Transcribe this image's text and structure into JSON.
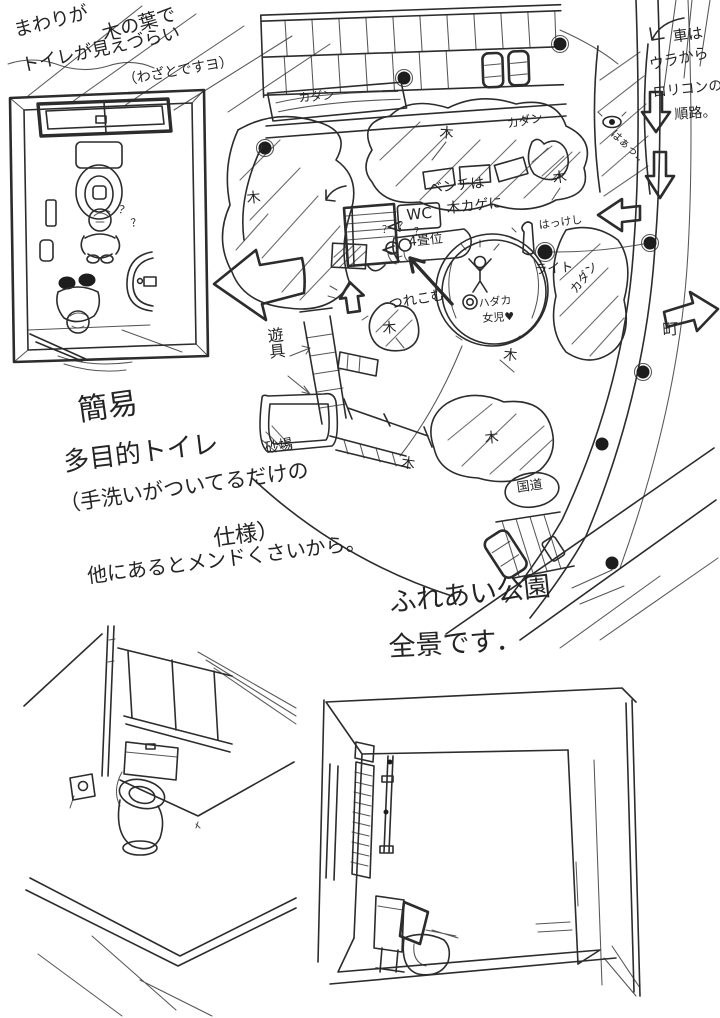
{
  "page": {
    "background": "#ffffff",
    "ink": "#2c2c2c"
  },
  "notes": {
    "hidden_toilet": {
      "l1": "まわりが",
      "l2": "木の葉で",
      "l3": "トイレが見えづらい",
      "l4": "（わざとですヨ）"
    },
    "car_route": {
      "l1": "車は",
      "l2": "ウラから",
      "l3": "ロリコンの",
      "l4": "順路。",
      "breath": "はぁっ‥"
    },
    "toilet_spec": {
      "l1": "簡易",
      "l2": "多目的トイレ",
      "l3": "（手洗いがついてるだけの",
      "l4": "仕様）",
      "l5": "他にあるとメンドくさいから。"
    },
    "park_caption": {
      "l1": "ふれあい公園",
      "l2": "全景です．"
    }
  },
  "map_labels": {
    "wc": "WC",
    "wc_size": "4畳位",
    "bench1": "ベンチは",
    "bench2": "木カゲに",
    "light": "ライト",
    "flowerbed": "カダン",
    "tree": "木",
    "hakkeshi": "はっけし",
    "fountain1": "ハダカ",
    "fountain2": "女児♥",
    "tsurekomu": "つれこむ",
    "playground": "遊具",
    "sandbox": "砂場",
    "highway": "国道",
    "town": "町",
    "question": "？"
  }
}
